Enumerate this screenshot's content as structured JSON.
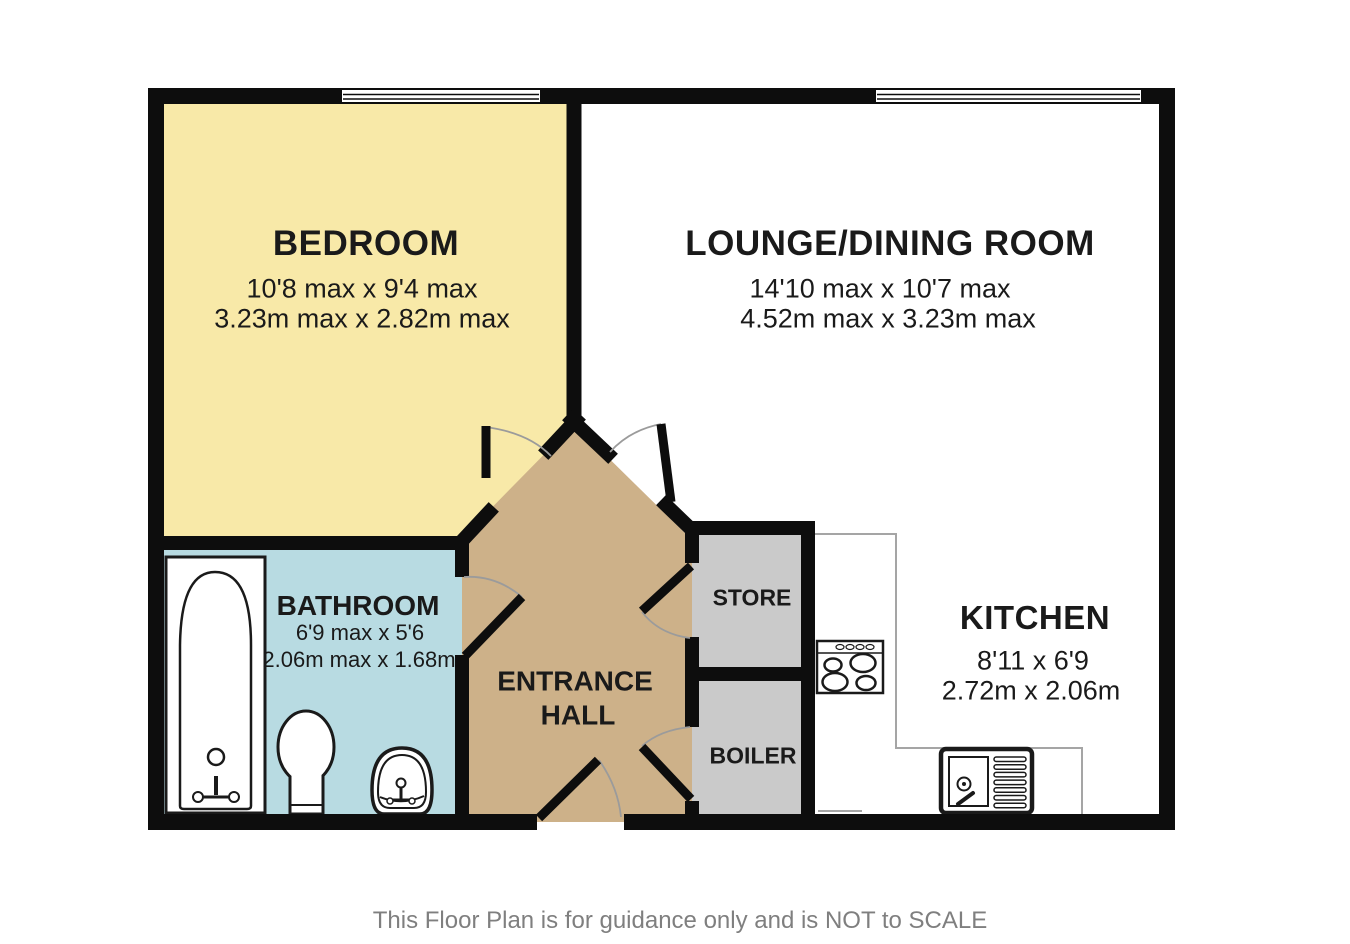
{
  "plan": {
    "rooms": {
      "bedroom": {
        "name": "BEDROOM",
        "dims_imperial": "10'8 max x 9'4 max",
        "dims_metric": "3.23m max x 2.82m max"
      },
      "lounge": {
        "name": "LOUNGE/DINING ROOM",
        "dims_imperial": "14'10 max x 10'7 max",
        "dims_metric": "4.52m max x 3.23m max"
      },
      "bathroom": {
        "name": "BATHROOM",
        "dims_imperial": "6'9 max x 5'6",
        "dims_metric": "2.06m max x 1.68m"
      },
      "entrance_hall": {
        "name_line1": "ENTRANCE",
        "name_line2": "HALL"
      },
      "store": {
        "name": "STORE"
      },
      "boiler": {
        "name": "BOILER"
      },
      "kitchen": {
        "name": "KITCHEN",
        "dims_imperial": "8'11 x 6'9",
        "dims_metric": "2.72m x 2.06m"
      }
    },
    "footer": "This Floor Plan is for guidance only and is NOT to SCALE",
    "colors": {
      "bedroom": "#F8E9A8",
      "bathroom": "#B8DBE2",
      "entrance_hall": "#CDB189",
      "store_boiler": "#CACACA",
      "lounge": "#FFFFFF",
      "kitchen": "#FFFFFF",
      "wall": "#0D0D0D",
      "door_arc": "#9B9B9B",
      "counter_line": "#A5A5A5",
      "label_text": "#1A1A1A",
      "footer_text": "#7F7F7F"
    },
    "icons": [
      "window",
      "door-swing",
      "bathtub",
      "toilet",
      "wash-basin",
      "hob",
      "kitchen-sink"
    ]
  }
}
